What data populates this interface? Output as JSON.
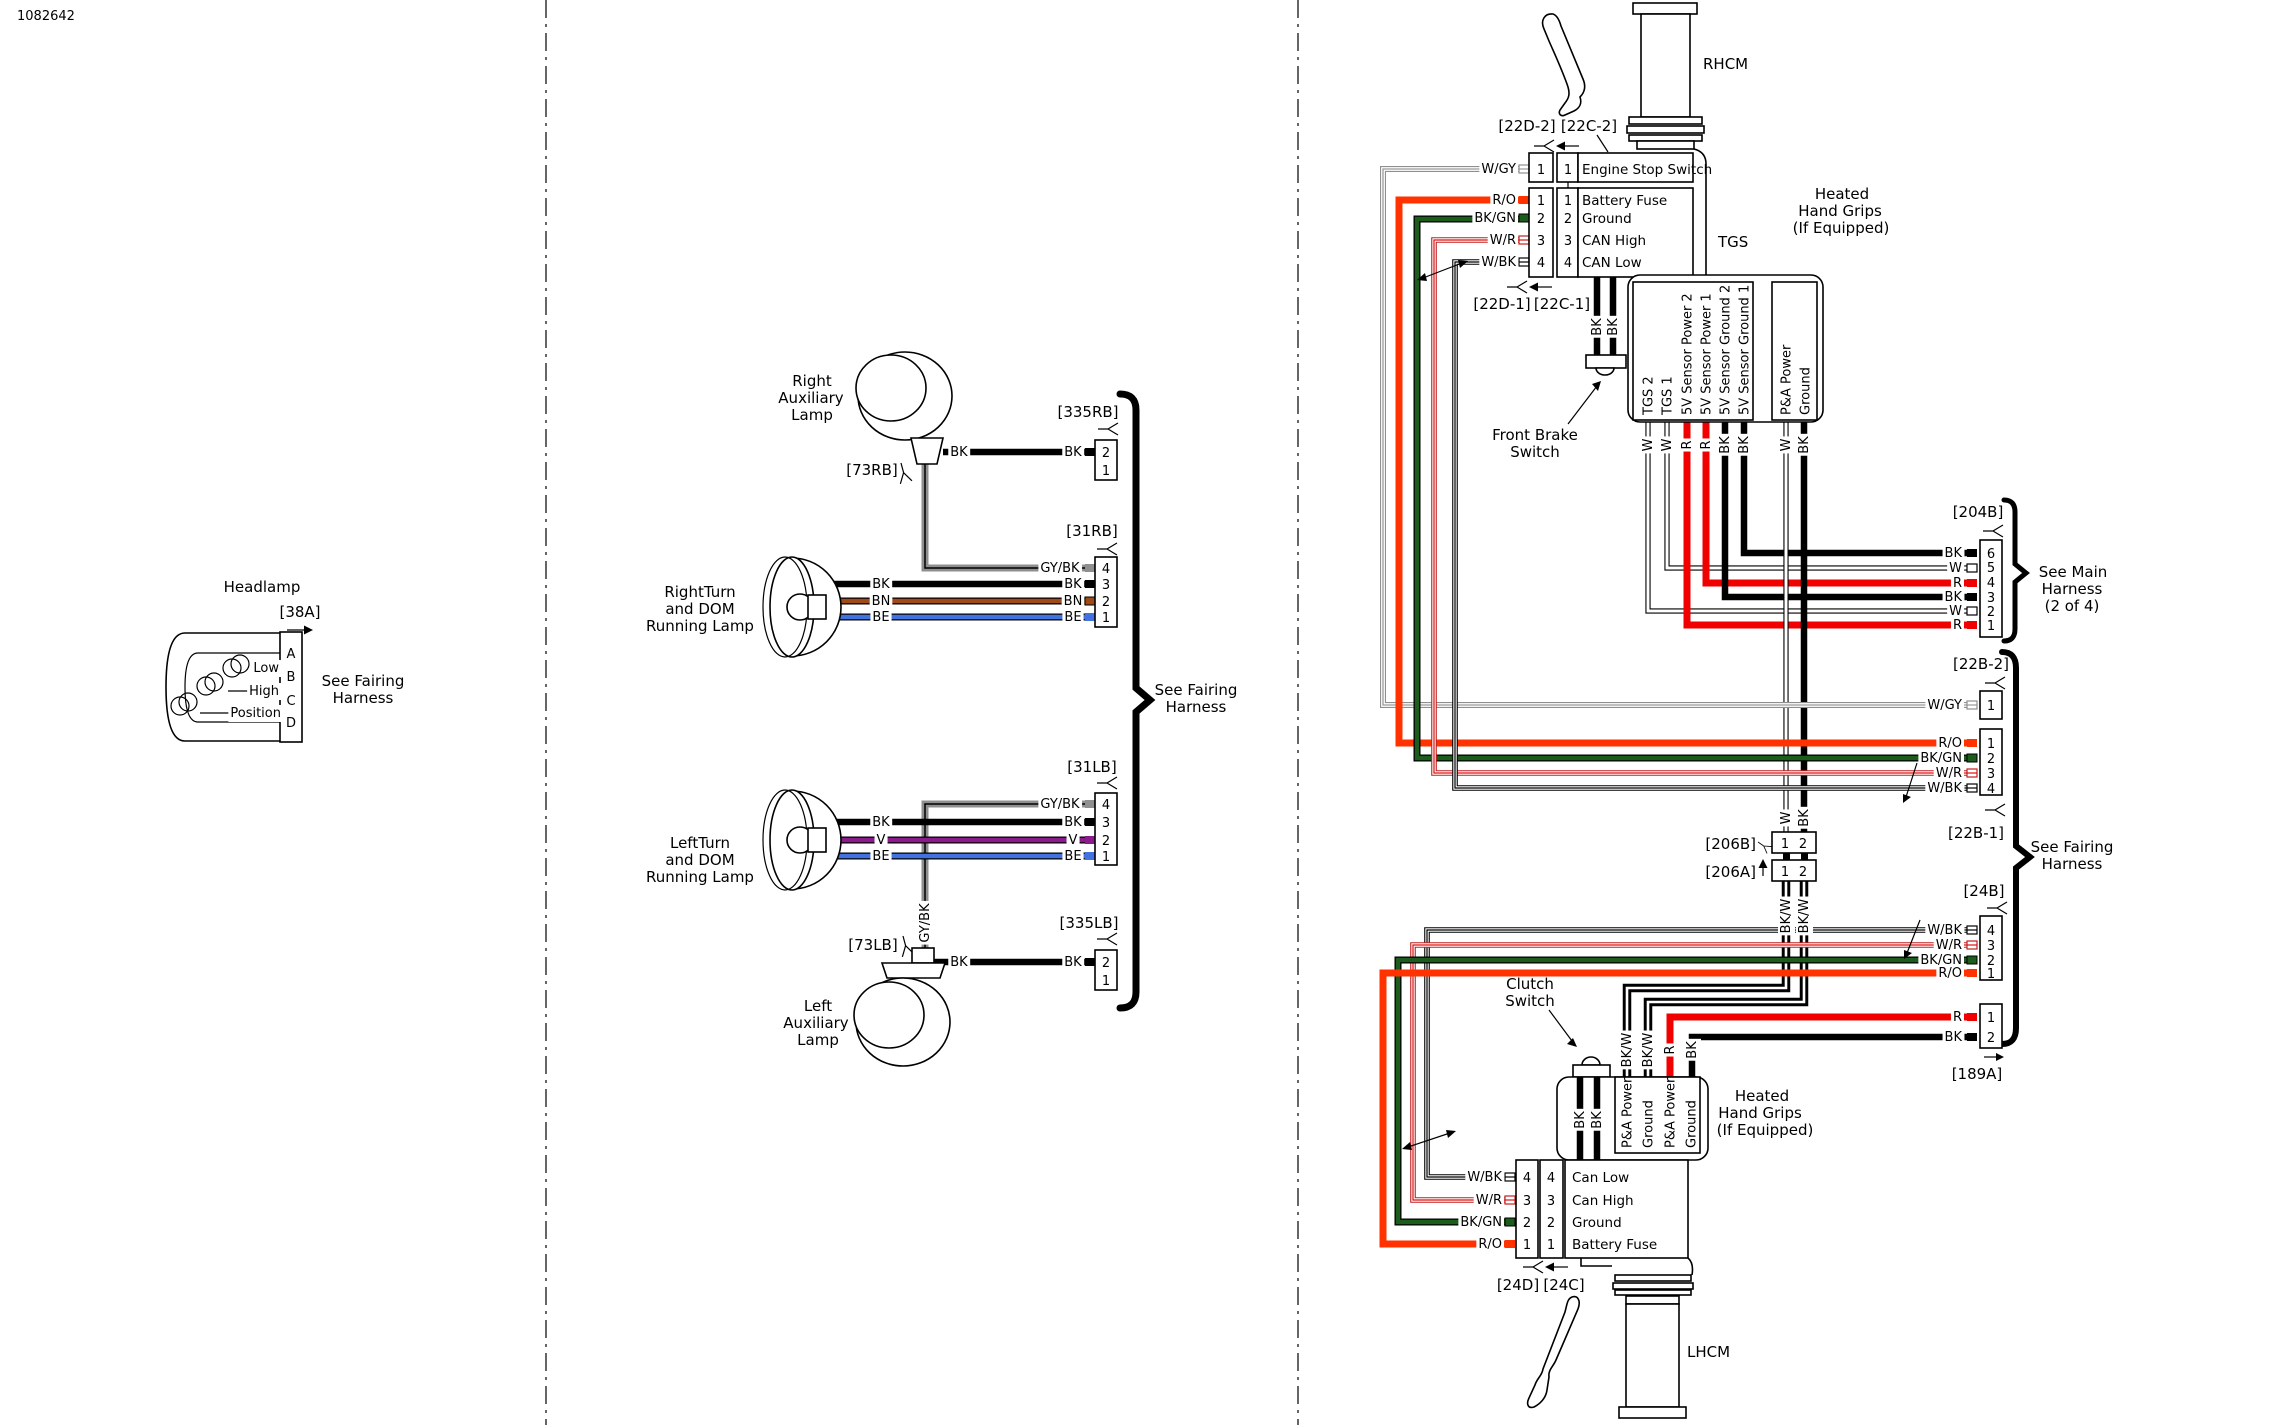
{
  "doc_number": "1082642",
  "pins": {
    "p1": "1",
    "p2": "2",
    "p3": "3",
    "p4": "4",
    "p5": "5",
    "p6": "6",
    "pA": "A",
    "pB": "B",
    "pC": "C",
    "pD": "D"
  },
  "wire_labels": {
    "w": "W",
    "bk": "BK",
    "r": "R",
    "wgy": "W/GY",
    "ro": "R/O",
    "bkgn": "BK/GN",
    "wr": "W/R",
    "wbk": "W/BK",
    "bkw": "BK/W",
    "gybk": "GY/BK",
    "bn": "BN",
    "be": "BE",
    "v": "V"
  },
  "connectors": {
    "c38a": "[38A]",
    "c335rb": "[335RB]",
    "c73rb": "[73RB]",
    "c31rb": "[31RB]",
    "c31lb": "[31LB]",
    "c73lb": "[73LB]",
    "c335lb": "[335LB]",
    "c22d2": "[22D-2]",
    "c22c2": "[22C-2]",
    "c22d1": "[22D-1]",
    "c22c1": "[22C-1]",
    "c204b": "[204B]",
    "c22b2": "[22B-2]",
    "c22b1": "[22B-1]",
    "c206b": "[206B]",
    "c206a": "[206A]",
    "c24b": "[24B]",
    "c189a": "[189A]",
    "c24d": "[24D]",
    "c24c": "[24C]"
  },
  "labels": {
    "headlamp": "Headlamp",
    "rhcm": "RHCM",
    "lhcm": "LHCM",
    "tgs": "TGS",
    "headlamp_low": "Low",
    "headlamp_high": "High",
    "headlamp_position": "Position",
    "right_aux": [
      "Right",
      "Auxiliary",
      "Lamp"
    ],
    "left_aux": [
      "Left",
      "Auxiliary",
      "Lamp"
    ],
    "right_turn": [
      "RightTurn",
      "and DOM",
      "Running Lamp"
    ],
    "left_turn": [
      "LeftTurn",
      "and DOM",
      "Running Lamp"
    ],
    "see_fairing": [
      "See Fairing",
      "Harness"
    ],
    "see_main": [
      "See Main",
      "Harness",
      "(2 of 4)"
    ],
    "heated_grips": [
      "Heated",
      "Hand Grips",
      "(If Equipped)"
    ],
    "front_brake": [
      "Front Brake",
      "Switch"
    ],
    "clutch": [
      "Clutch",
      "Switch"
    ]
  },
  "functions": {
    "rhcm": [
      "Engine Stop Switch",
      "Battery Fuse",
      "Ground",
      "CAN High",
      "CAN Low"
    ],
    "lhcm": [
      "Can Low",
      "Can High",
      "Ground",
      "Battery Fuse"
    ]
  },
  "tgs_columns": [
    "TGS 2",
    "TGS 1",
    "5V Sensor Power 2",
    "5V Sensor Power 1",
    "5V Sensor Ground 2",
    "5V Sensor Ground 1"
  ],
  "pa_columns": [
    "P&A Power",
    "Ground"
  ],
  "grip_columns": [
    "P&A Power",
    "Ground",
    "P&A Power",
    "Ground"
  ],
  "colors": {
    "black": "#000000",
    "red": "#f10000",
    "red_orange": "#ff3200",
    "green": "#1c5c1c",
    "blue": "#4272e0",
    "violet": "#8b1b8b",
    "brown": "#a04a1a",
    "gray": "#8f8f8f"
  }
}
